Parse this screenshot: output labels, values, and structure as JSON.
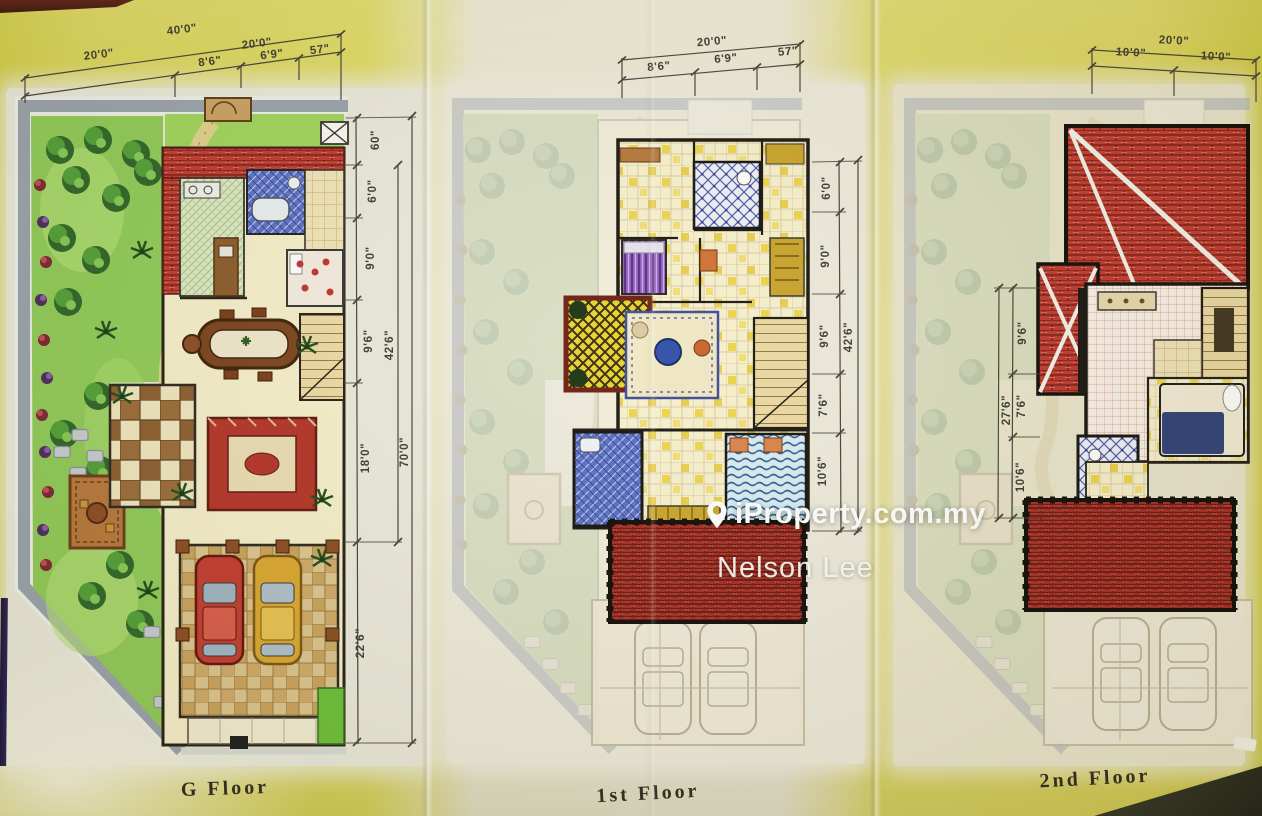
{
  "watermark": {
    "brand": "iProperty.com.my",
    "agent": "Nelson Lee"
  },
  "panels": [
    {
      "id": "g-floor",
      "label": "G Floor",
      "dims": {
        "top": {
          "total": "40'0\"",
          "half_left": "20'0\"",
          "half_right": "20'0\"",
          "sub": [
            "8'6\"",
            "6'9\"",
            "57\""
          ]
        },
        "right": {
          "segments": [
            "60\"",
            "6'0\"",
            "9'0\"",
            "9'6\"",
            "18'0\"",
            "22'6\""
          ],
          "subtotal": "42'6\"",
          "total": "70'0\""
        }
      }
    },
    {
      "id": "first-floor",
      "label": "1st Floor",
      "dims": {
        "top": {
          "total": "20'0\"",
          "sub": [
            "8'6\"",
            "6'9\"",
            "57\""
          ]
        },
        "right": {
          "segments": [
            "6'0\"",
            "9'0\"",
            "9'6\"",
            "7'6\"",
            "10'6\""
          ],
          "total": "42'6\""
        }
      }
    },
    {
      "id": "second-floor",
      "label": "2nd Floor",
      "dims": {
        "top": {
          "total": "20'0\"",
          "sub": [
            "10'0\"",
            "10'0\""
          ]
        },
        "left": {
          "segments": [
            "9'6\"",
            "7'6\"",
            "10'6\""
          ],
          "total": "27'6\""
        }
      }
    }
  ],
  "colors": {
    "paper_yellow": "#ddd45c",
    "paper_cream": "#ece9d7",
    "roof_red": "#bf3a30",
    "porch_roof_red": "#a22a22",
    "garden_green": "#8fca58",
    "plot_border_gray": "#99a2ad",
    "dimension_text": "#3c3a33",
    "watermark_white": "#ffffff",
    "bath_blue": "#5a6fc5",
    "balcony_yellow": "#e8d22a"
  }
}
